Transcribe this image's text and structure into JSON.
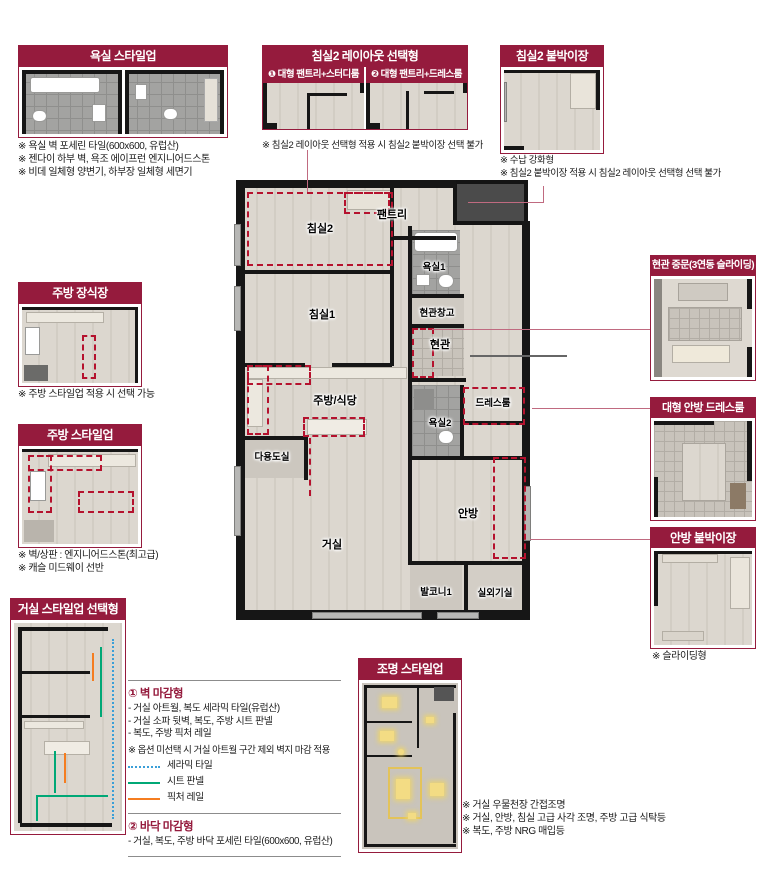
{
  "colors": {
    "accent_maroon": "#951b3d",
    "option_dashed_red": "#b5122e",
    "connector_rose": "#c06a80",
    "wall_black": "#161616",
    "key_ceramic_tile": "#3a9fd8",
    "key_sheet_panel": "#00a876",
    "key_picture_rail": "#f57d20"
  },
  "boxes": {
    "bath": {
      "title": "욕실 스타일업",
      "notes": [
        "※ 욕실 벽 포세린 타일(600x600, 유럽산)",
        "※ 젠다이 하부 벽, 욕조 에이프런 엔지니어드스톤",
        "※ 비데 일체형 양변기, 하부장 일체형 세면기"
      ]
    },
    "bed2_layout": {
      "title": "침실2 레이아웃 선택형",
      "option1": "❶ 대형 팬트리+스터디룸",
      "option2": "❷ 대형 팬트리+드레스룸",
      "note": "※ 침실2 레이아웃 선택형 적용 시 침실2 붙박이장 선택 불가"
    },
    "bed2_closet": {
      "title": "침실2 붙박이장",
      "notes": [
        "※ 수납 강화형",
        "※ 침실2 붙박이장 적용 시 침실2 레이아웃 선택형 선택 불가"
      ]
    },
    "kitchen_cabinet": {
      "title": "주방 장식장",
      "note": "※ 주방 스타일업 적용 시 선택 가능"
    },
    "kitchen_style": {
      "title": "주방 스타일업",
      "notes": [
        "※ 벽/상판 : 엔지니어드스톤(최고급)",
        "※ 캐슬 미드웨이 선반"
      ]
    },
    "living_style": {
      "title": "거실 스타일업 선택형"
    },
    "entrance_door": {
      "title": "현관 중문(3연동 슬라이딩)"
    },
    "master_dress": {
      "title": "대형 안방 드레스룸"
    },
    "master_closet": {
      "title": "안방 붙박이장",
      "note": "※ 슬라이딩형"
    },
    "lighting": {
      "title": "조명 스타일업",
      "notes": [
        "※ 거실 우물천장 간접조명",
        "※ 거실, 안방, 침실 고급 사각 조명, 주방 고급 식탁등",
        "※ 복도, 주방 NRG 매입등"
      ]
    }
  },
  "legend": {
    "wall": {
      "heading": "① 벽 마감형",
      "items": [
        "- 거실 아트월, 복도 세라믹 타일(유럽산)",
        "- 거실 소파 뒷벽, 복도, 주방 시트 판넬",
        "- 복도, 주방 픽처 레일"
      ],
      "note": "※ 옵션 미선택 시 거실 아트월 구간 제외 벽지 마감 적용",
      "keys": [
        {
          "label": "세라믹 타일",
          "color": "#3a9fd8",
          "line": "dotted"
        },
        {
          "label": "시트 판넬",
          "color": "#00a876",
          "line": "solid"
        },
        {
          "label": "픽처 레일",
          "color": "#f57d20",
          "line": "solid"
        }
      ]
    },
    "floor": {
      "heading": "② 바닥 마감형",
      "items": [
        "- 거실, 복도, 주방 바닥 포세린 타일(600x600, 유럽산)"
      ]
    }
  },
  "floorplan": {
    "labels": {
      "bed2": "침실2",
      "pantry": "팬트리",
      "bath1": "욕실1",
      "entry_storage": "현관창고",
      "entry": "현관",
      "bed1": "침실1",
      "kitchen": "주방/식당",
      "utility": "다용도실",
      "bath2": "욕실2",
      "dressroom": "드레스룸",
      "master": "안방",
      "living": "거실",
      "balcony1": "발코니1",
      "outdoor_unit": "실외기실"
    }
  }
}
